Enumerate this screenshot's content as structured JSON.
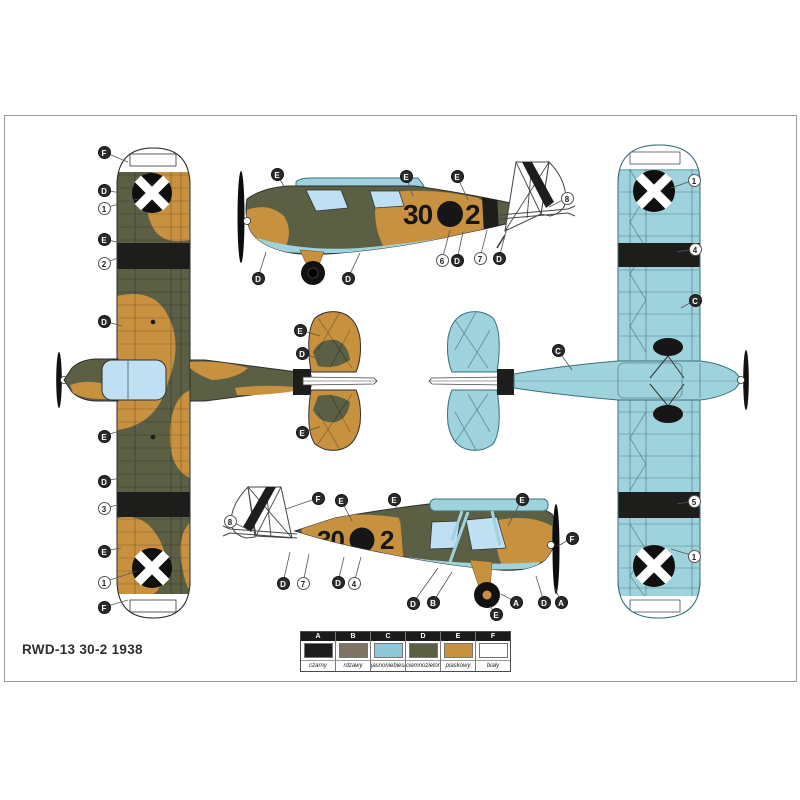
{
  "page": {
    "title": "RWD-13 30-2 1938"
  },
  "aircraft": {
    "code_left": "30",
    "code_right": "2"
  },
  "palette": {
    "black": "#1d1d1b",
    "rust": "#7d7466",
    "blue": "#9ed2dc",
    "green": "#5b5f44",
    "sand": "#c8913f",
    "white": "#ffffff",
    "canopy": "#bfdff2",
    "outline": "#2e2e2e"
  },
  "legend": {
    "columns": [
      {
        "letter": "A",
        "color": "#1d1d1b",
        "name": "czarny"
      },
      {
        "letter": "B",
        "color": "#7d7466",
        "name": "rdzawy"
      },
      {
        "letter": "C",
        "color": "#8fc8d8",
        "name": "jasnoniebieski"
      },
      {
        "letter": "D",
        "color": "#5b5f44",
        "name": "ciemnozielony"
      },
      {
        "letter": "E",
        "color": "#c8913f",
        "name": "piaskowy"
      },
      {
        "letter": "F",
        "color": "#ffffff",
        "name": "biały"
      }
    ]
  },
  "callouts": [
    {
      "label": "F",
      "type": "letter",
      "x": 104,
      "y": 152,
      "tx": 128,
      "ty": 162
    },
    {
      "label": "D",
      "type": "letter",
      "x": 104,
      "y": 190,
      "tx": 121,
      "ty": 193
    },
    {
      "label": "1",
      "type": "number",
      "x": 104,
      "y": 208,
      "tx": 138,
      "ty": 199
    },
    {
      "label": "E",
      "type": "letter",
      "x": 104,
      "y": 239,
      "tx": 121,
      "ty": 243
    },
    {
      "label": "2",
      "type": "number",
      "x": 104,
      "y": 263,
      "tx": 118,
      "ty": 258
    },
    {
      "label": "D",
      "type": "letter",
      "x": 104,
      "y": 321,
      "tx": 122,
      "ty": 326
    },
    {
      "label": "E",
      "type": "letter",
      "x": 104,
      "y": 436,
      "tx": 122,
      "ty": 430
    },
    {
      "label": "D",
      "type": "letter",
      "x": 104,
      "y": 481,
      "tx": 121,
      "ty": 478
    },
    {
      "label": "3",
      "type": "number",
      "x": 104,
      "y": 508,
      "tx": 118,
      "ty": 505
    },
    {
      "label": "E",
      "type": "letter",
      "x": 104,
      "y": 551,
      "tx": 121,
      "ty": 548
    },
    {
      "label": "1",
      "type": "number",
      "x": 104,
      "y": 582,
      "tx": 137,
      "ty": 571
    },
    {
      "label": "F",
      "type": "letter",
      "x": 104,
      "y": 607,
      "tx": 128,
      "ty": 600
    },
    {
      "label": "E",
      "type": "letter",
      "x": 300,
      "y": 330,
      "tx": 320,
      "ty": 336
    },
    {
      "label": "D",
      "type": "letter",
      "x": 302,
      "y": 353,
      "tx": 322,
      "ty": 360
    },
    {
      "label": "E",
      "type": "letter",
      "x": 302,
      "y": 432,
      "tx": 320,
      "ty": 427
    },
    {
      "label": "E",
      "type": "letter",
      "x": 277,
      "y": 174,
      "tx": 296,
      "ty": 208
    },
    {
      "label": "E",
      "type": "letter",
      "x": 406,
      "y": 176,
      "tx": 413,
      "ty": 196
    },
    {
      "label": "E",
      "type": "letter",
      "x": 457,
      "y": 176,
      "tx": 468,
      "ty": 200
    },
    {
      "label": "8",
      "type": "number",
      "x": 567,
      "y": 198,
      "tx": 549,
      "ty": 207
    },
    {
      "label": "D",
      "type": "letter",
      "x": 258,
      "y": 278,
      "tx": 266,
      "ty": 252
    },
    {
      "label": "D",
      "type": "letter",
      "x": 348,
      "y": 278,
      "tx": 360,
      "ty": 253
    },
    {
      "label": "6",
      "type": "number",
      "x": 442,
      "y": 260,
      "tx": 450,
      "ty": 230
    },
    {
      "label": "D",
      "type": "letter",
      "x": 457,
      "y": 260,
      "tx": 463,
      "ty": 232
    },
    {
      "label": "7",
      "type": "number",
      "x": 480,
      "y": 258,
      "tx": 487,
      "ty": 230
    },
    {
      "label": "D",
      "type": "letter",
      "x": 499,
      "y": 258,
      "tx": 507,
      "ty": 228
    },
    {
      "label": "C",
      "type": "letter",
      "x": 558,
      "y": 350,
      "tx": 572,
      "ty": 370
    },
    {
      "label": "C",
      "type": "letter",
      "x": 695,
      "y": 300,
      "tx": 681,
      "ty": 308
    },
    {
      "label": "1",
      "type": "number",
      "x": 694,
      "y": 180,
      "tx": 671,
      "ty": 188
    },
    {
      "label": "4",
      "type": "number",
      "x": 695,
      "y": 249,
      "tx": 677,
      "ty": 252
    },
    {
      "label": "5",
      "type": "number",
      "x": 694,
      "y": 501,
      "tx": 677,
      "ty": 504
    },
    {
      "label": "1",
      "type": "number",
      "x": 694,
      "y": 556,
      "tx": 671,
      "ty": 549
    },
    {
      "label": "8",
      "type": "number",
      "x": 230,
      "y": 521,
      "tx": 245,
      "ty": 528
    },
    {
      "label": "F",
      "type": "letter",
      "x": 318,
      "y": 498,
      "tx": 286,
      "ty": 509
    },
    {
      "label": "E",
      "type": "letter",
      "x": 341,
      "y": 500,
      "tx": 352,
      "ty": 521
    },
    {
      "label": "E",
      "type": "letter",
      "x": 394,
      "y": 499,
      "tx": 400,
      "ty": 521
    },
    {
      "label": "E",
      "type": "letter",
      "x": 522,
      "y": 499,
      "tx": 508,
      "ty": 526
    },
    {
      "label": "F",
      "type": "letter",
      "x": 572,
      "y": 538,
      "tx": 558,
      "ty": 546
    },
    {
      "label": "D",
      "type": "letter",
      "x": 283,
      "y": 583,
      "tx": 290,
      "ty": 552
    },
    {
      "label": "7",
      "type": "number",
      "x": 303,
      "y": 583,
      "tx": 309,
      "ty": 554
    },
    {
      "label": "D",
      "type": "letter",
      "x": 338,
      "y": 582,
      "tx": 344,
      "ty": 557
    },
    {
      "label": "4",
      "type": "number",
      "x": 354,
      "y": 583,
      "tx": 361,
      "ty": 557
    },
    {
      "label": "D",
      "type": "letter",
      "x": 413,
      "y": 603,
      "tx": 438,
      "ty": 568
    },
    {
      "label": "B",
      "type": "letter",
      "x": 433,
      "y": 602,
      "tx": 452,
      "ty": 572
    },
    {
      "label": "A",
      "type": "letter",
      "x": 516,
      "y": 602,
      "tx": 501,
      "ty": 594
    },
    {
      "label": "E",
      "type": "letter",
      "x": 496,
      "y": 614,
      "tx": 490,
      "ty": 606
    },
    {
      "label": "D",
      "type": "letter",
      "x": 544,
      "y": 602,
      "tx": 536,
      "ty": 576
    },
    {
      "label": "A",
      "type": "letter",
      "x": 561,
      "y": 602,
      "tx": 554,
      "ty": 586
    }
  ]
}
